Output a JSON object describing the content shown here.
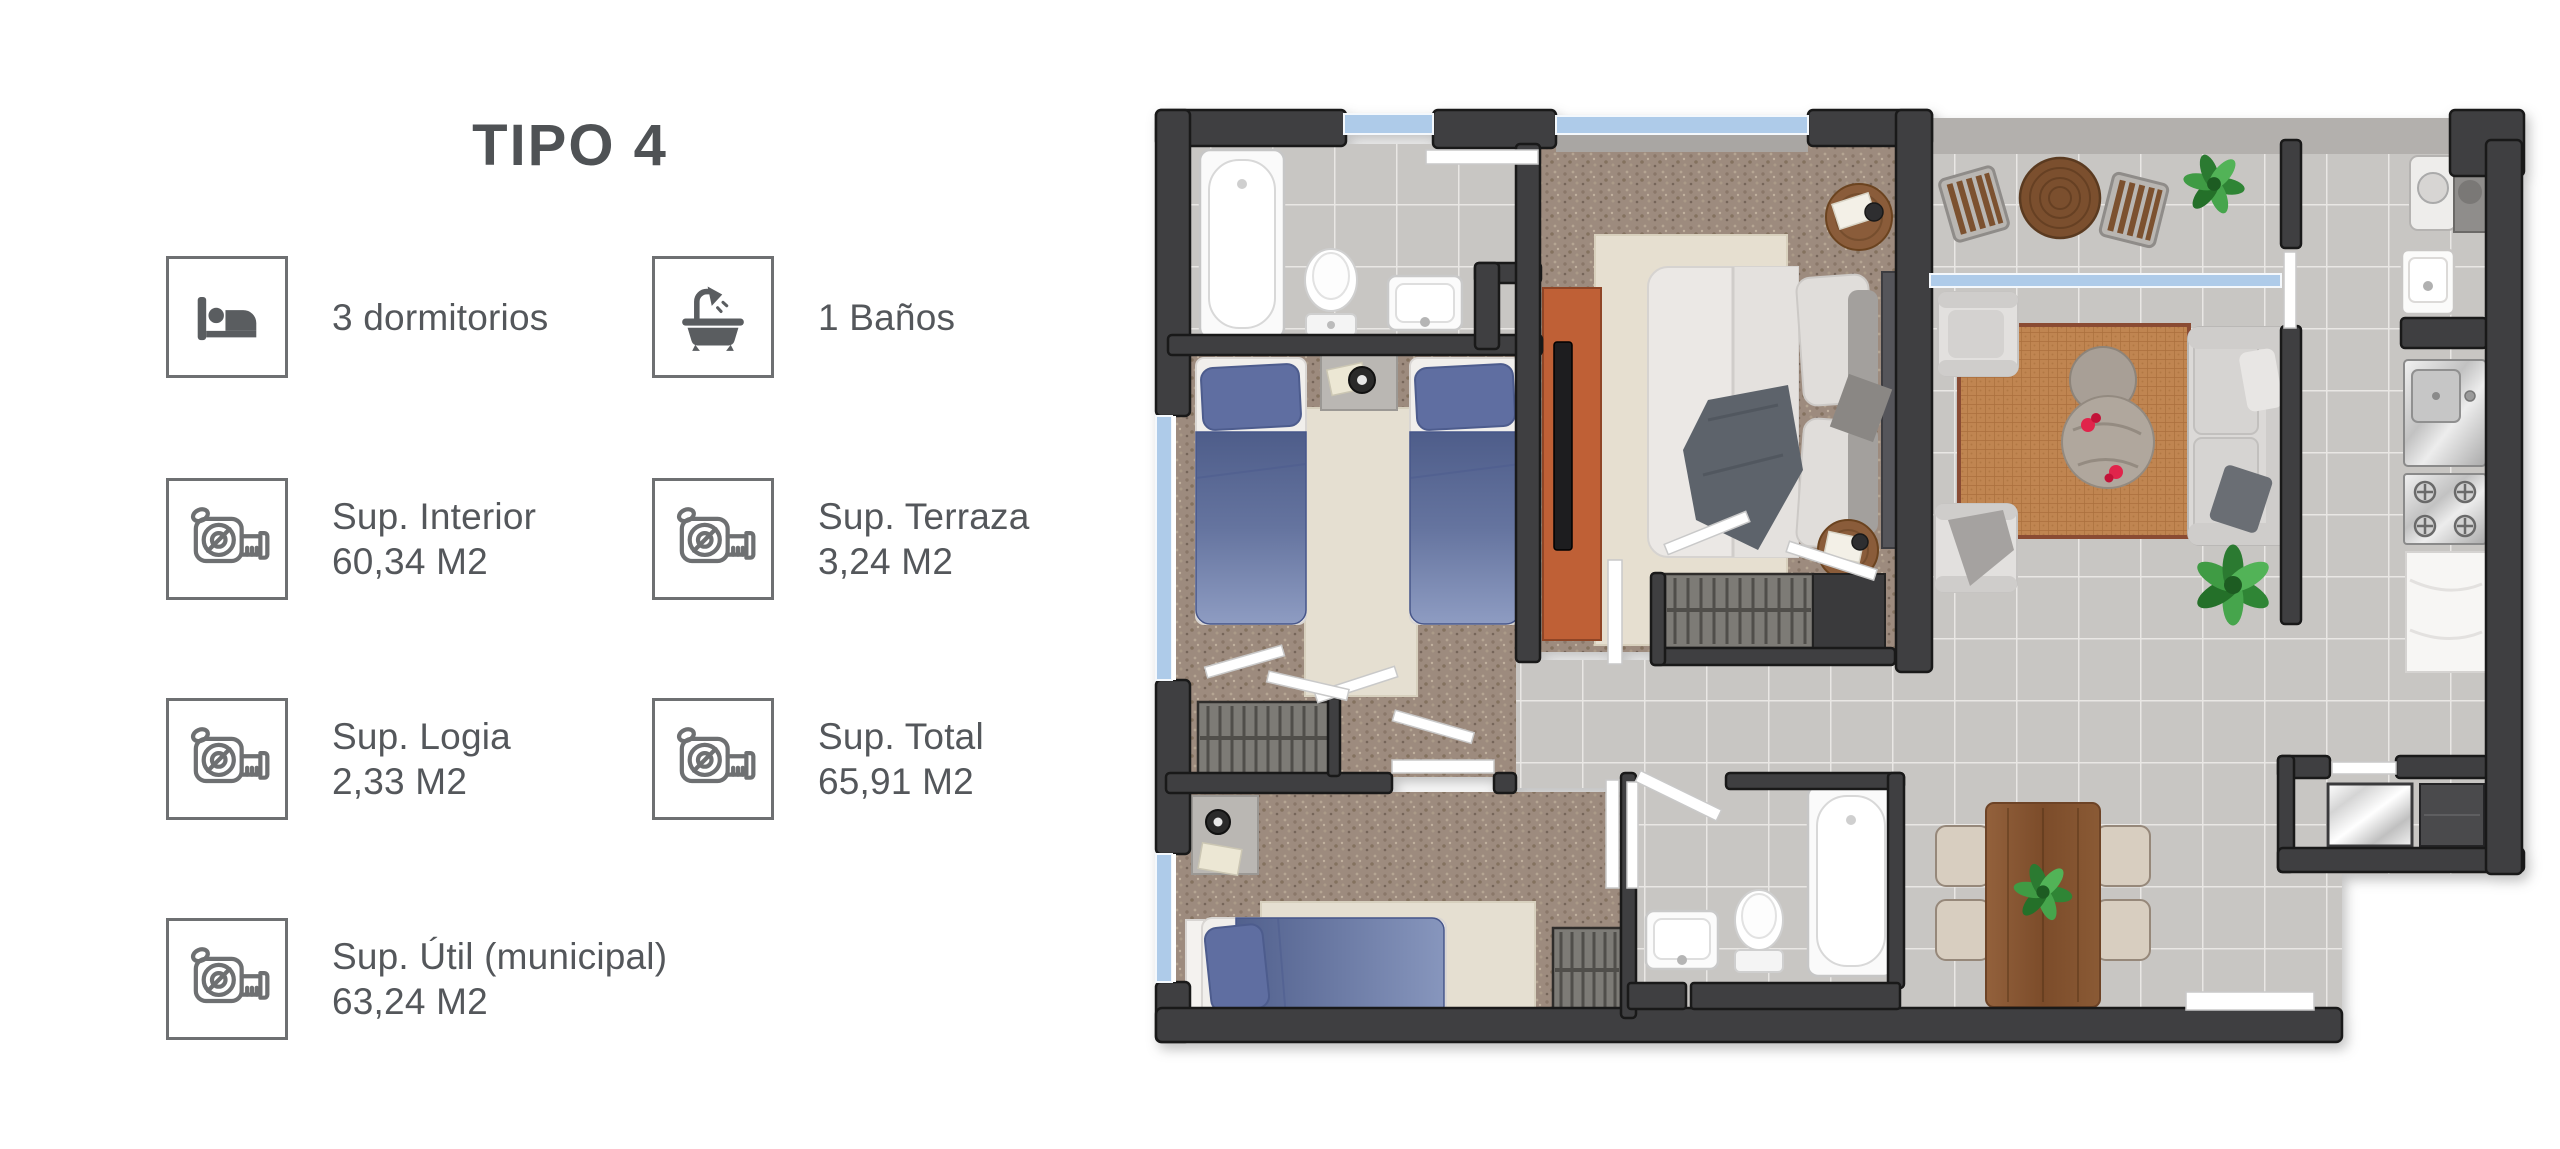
{
  "panel": {
    "title": "TIPO 4",
    "specs": [
      {
        "icon": "bed-icon",
        "label": "3 dormitorios",
        "value": ""
      },
      {
        "icon": "bath-icon",
        "label": "1 Baños",
        "value": ""
      },
      {
        "icon": "tape-measure-icon",
        "label": "Sup. Interior",
        "value": "60,34 M2"
      },
      {
        "icon": "tape-measure-icon",
        "label": "Sup. Terraza",
        "value": "3,24 M2"
      },
      {
        "icon": "tape-measure-icon",
        "label": "Sup. Logia",
        "value": "2,33 M2"
      },
      {
        "icon": "tape-measure-icon",
        "label": "Sup. Total",
        "value": "65,91 M2"
      },
      {
        "icon": "tape-measure-icon",
        "label": "Sup. Útil (municipal)",
        "value": "63,24 M2"
      }
    ]
  },
  "floorplan": {
    "rooms": [
      "bathroom-1",
      "twin-bedroom",
      "master-bedroom",
      "terrace",
      "living-room",
      "kitchen",
      "hall",
      "bedroom-3",
      "bathroom-2",
      "dining-area",
      "logia"
    ],
    "colors": {
      "wall": "#3f3f41",
      "tile": "#c8c6c3",
      "carpet": "#9d8b7e",
      "cream_rug": "#e5dfd1",
      "bed_blue": "#5f6ea1",
      "accent_orange": "#bf6036",
      "rattan_rug": "#c08551",
      "window_glass": "#aecbe9",
      "wood": "#8b5a38",
      "text": "#54575b"
    }
  }
}
